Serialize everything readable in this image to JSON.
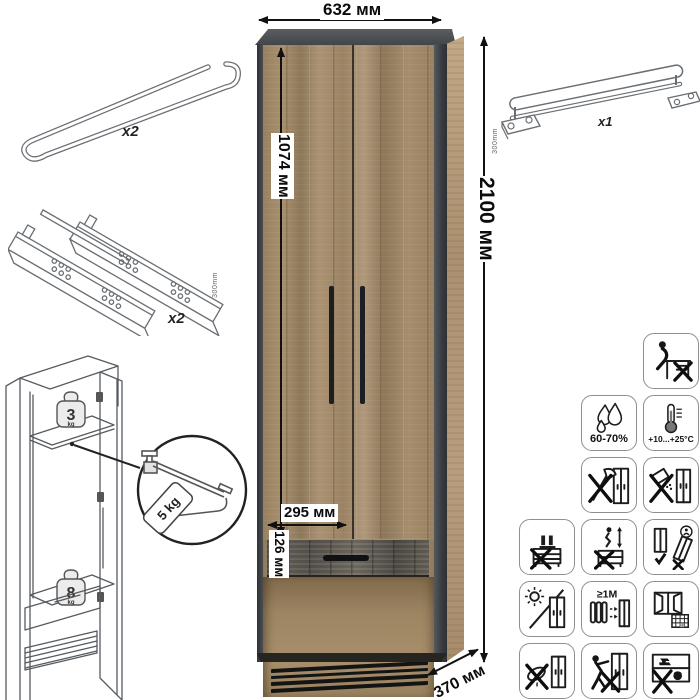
{
  "product": {
    "width_label": "632 мм",
    "height_label": "2100 мм",
    "door_height_label": "1074 мм",
    "inner_width_label": "295 мм",
    "drawer_height_label": "126 мм",
    "depth_label": "370 мм"
  },
  "parts": {
    "hanger_rod_qty": "x2",
    "drawer_slides_qty": "x2",
    "drawer_slides_length": "300mm",
    "pullout_rail_qty": "x1",
    "pullout_rail_length": "300mm"
  },
  "load": {
    "shelf_value": "3",
    "shelf_unit": "kg",
    "drawer_value": "8",
    "drawer_unit": "kg",
    "rail_tag": "5 kg"
  },
  "care": {
    "humidity": "60-70%",
    "temperature": "+10...+25°C",
    "radiator_distance": "≥1M",
    "calendar_day": "21",
    "icons": [
      "no-sitting",
      "humidity",
      "temperature",
      "no-sharp-impact",
      "no-spilling",
      "no-standing",
      "no-jumping",
      "keep-upright",
      "no-direct-sunlight",
      "radiator-distance",
      "ventilate-room",
      "no-wet-cleaning",
      "no-dragging",
      "no-heavy-load"
    ]
  },
  "colors": {
    "wood": "#a18a6a",
    "dark_frame": "#42464a",
    "drawer_front": "#57534d",
    "dimension_text": "#0c0c0c"
  }
}
